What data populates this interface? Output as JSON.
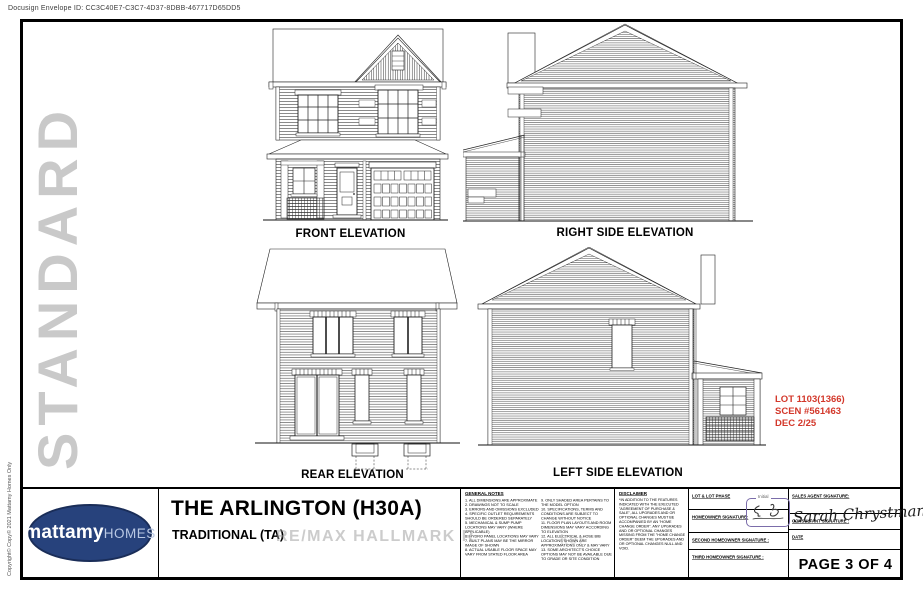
{
  "header": {
    "docusign_envelope": "Docusign Envelope ID: CC3C40E7-C3C7-4D37-8DBB-467717D65DD5"
  },
  "margins": {
    "standard_label": "STANDARD",
    "copyright_note": "Copyright© Copy© 2021 Mattamy Homes Only"
  },
  "watermark": {
    "text": "RE/MAX HALLMARK R",
    "fragment": "ker"
  },
  "elevations": {
    "front_label": "FRONT ELEVATION",
    "right_label": "RIGHT SIDE ELEVATION",
    "rear_label": "REAR ELEVATION",
    "left_label": "LEFT SIDE ELEVATION"
  },
  "lot_annotation": {
    "lines": [
      "LOT 1103(1366)",
      "SCEN #561463",
      "DEC 2/25"
    ],
    "color": "#d3382b"
  },
  "title_block": {
    "logo": {
      "brand_primary": "mattamy",
      "brand_secondary": "HOMES",
      "oval_color": "#27427c"
    },
    "model_name": "THE ARLINGTON (H30A)",
    "model_style": "TRADITIONAL (TA)",
    "general_notes": {
      "heading": "GENERAL NOTES",
      "column1": [
        "1. ALL DIMENSIONS ARE APPROXIMATE",
        "2. DRAWINGS NOT TO SCALE",
        "3. ERRORS AND OMISSIONS EXCLUDED",
        "4. SPECIFIC OUTLET REQUIREMENTS SHOULD BE ORDERED SEPARATELY",
        "5. MECHANICAL & SUMP PUMP LOCATIONS MAY VARY (WHERE APPLICABLE)",
        "6. HYDRO PANEL LOCATIONS MAY VARY",
        "7. BUILT PLANS MAY BE THE MIRROR IMAGE OF SHOWN",
        "8. ACTUAL USABLE FLOOR SPACE MAY VARY FROM STATED FLOOR AREA"
      ],
      "column2": [
        "9. ONLY SHADED AREA PERTAINS TO THE MODEL OPTION",
        "10. SPECIFICATIONS, TERMS AND CONDITIONS ARE SUBJECT TO CHANGE WITHOUT NOTICE",
        "11. FLOOR PLAN LAYOUTS AND ROOM DIMENSIONS MAY VARY ACCORDING TO ELEVATION",
        "12. ALL ELECTRICAL & HOSE BIB LOCATIONS SHOWN ARE APPROXIMATIONS ONLY & MAY VARY",
        "13. SOME ARCHITECT'S CHOICE OPTIONS MAY NOT BE AVAILABLE DUE TO GRADE OR SITE CONDITION"
      ]
    },
    "disclaimer": {
      "heading": "DISCLAIMER",
      "body": "*IN ADDITION TO THE FEATURES INDICATED WITH THE EXECUTED \"AGREEMENT OF PURCHASE & SALE\", ALL UPGRADES AND OR OPTIONAL CHANGES MUST BE ACCOMPANIED BY AN \"HOME CHANGE ORDER\". ANY UPGRADES AND OR OPTIONAL CHANGES MISSING FROM THE \"HOME CHANGE ORDER\" DEEM THE UPGRADES AND OR OPTIONAL CHANGES NULL AND VOID."
    },
    "signature_area": {
      "lot_phase_label": "LOT & LOT PHASE",
      "homeowner_label": "HOMEOWNER SIGNATURE:",
      "second_homeowner_label": "SECOND HOMEOWNER SIGNATURE :",
      "third_homeowner_label": "THIRD HOMEOWNER SIGNATURE :",
      "sales_agent_label": "SALES AGENT SIGNATURE:",
      "consultant_label": "CONSULTANT SIGNATURE :",
      "date_label": "DATE",
      "consultant_signature": "Sarah Chrystman",
      "initial_stamp_caption": "Initial"
    },
    "page_indicator": "PAGE 3 OF 4"
  }
}
